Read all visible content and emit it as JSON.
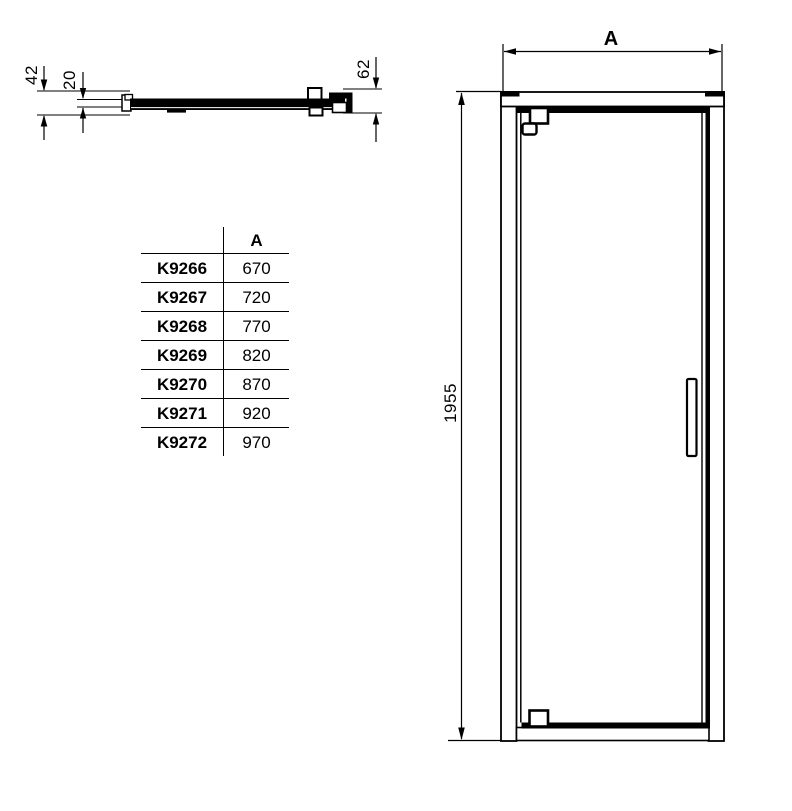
{
  "section_view": {
    "dim_42": "42",
    "dim_20": "20",
    "dim_62": "62"
  },
  "table": {
    "header_code": "",
    "header_a": "A",
    "rows": [
      {
        "code": "K9266",
        "a": "670"
      },
      {
        "code": "K9267",
        "a": "720"
      },
      {
        "code": "K9268",
        "a": "770"
      },
      {
        "code": "K9269",
        "a": "820"
      },
      {
        "code": "K9270",
        "a": "870"
      },
      {
        "code": "K9271",
        "a": "920"
      },
      {
        "code": "K9272",
        "a": "970"
      }
    ]
  },
  "front_view": {
    "dim_width_label": "A",
    "dim_height": "1955"
  },
  "colors": {
    "ink": "#000000",
    "paper": "#ffffff"
  }
}
